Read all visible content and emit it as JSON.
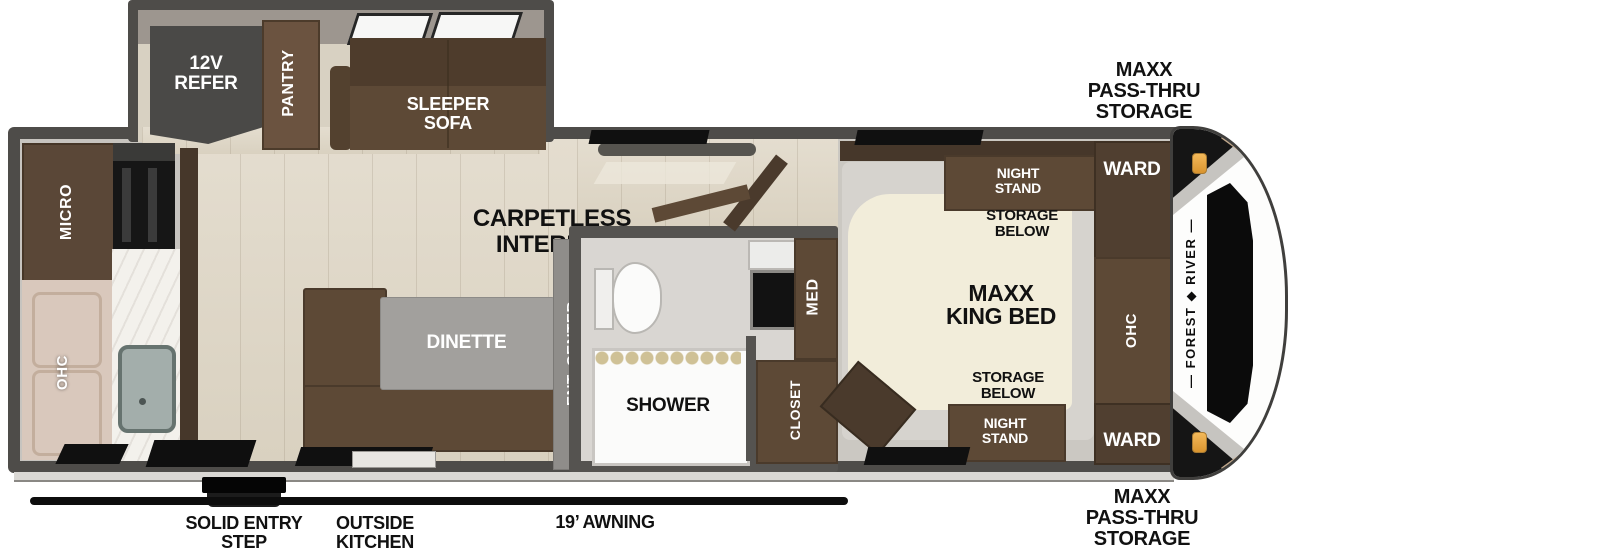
{
  "slide": {
    "refer": "12V\nREFER",
    "pantry": "PANTRY",
    "sofa": "SLEEPER\nSOFA"
  },
  "kitchen": {
    "micro": "MICRO",
    "ohc": "OHC"
  },
  "living": {
    "carpetless": "CARPETLESS\nINTERIOR",
    "dinette": "DINETTE",
    "ent_center": "ENT. CENTER"
  },
  "bath": {
    "shower": "SHOWER",
    "med": "MED",
    "closet": "CLOSET"
  },
  "bedroom": {
    "bed": "MAXX\nKING BED",
    "night_stand_top": "NIGHT\nSTAND",
    "storage_top": "STORAGE\nBELOW",
    "storage_bottom": "STORAGE\nBELOW",
    "night_stand_bottom": "NIGHT\nSTAND",
    "ward_top": "WARD",
    "ward_bottom": "WARD",
    "ohc": "OHC"
  },
  "cap": {
    "brand": "— FOREST ◆ RIVER —"
  },
  "exterior": {
    "pass_thru_top": "MAXX\nPASS-THRU\nSTORAGE",
    "pass_thru_bottom": "MAXX\nPASS-THRU\nSTORAGE",
    "step": "SOLID ENTRY\nSTEP",
    "outside_kitchen": "OUTSIDE\nKITCHEN",
    "awning": "19’ AWNING"
  },
  "colors": {
    "wall": "#4e4c49",
    "furniture_brown": "#5d4936",
    "dark_brown": "#46372a",
    "bed_cream": "#f2edda",
    "amber_light": "#e8a23c",
    "label_black": "#111111"
  }
}
